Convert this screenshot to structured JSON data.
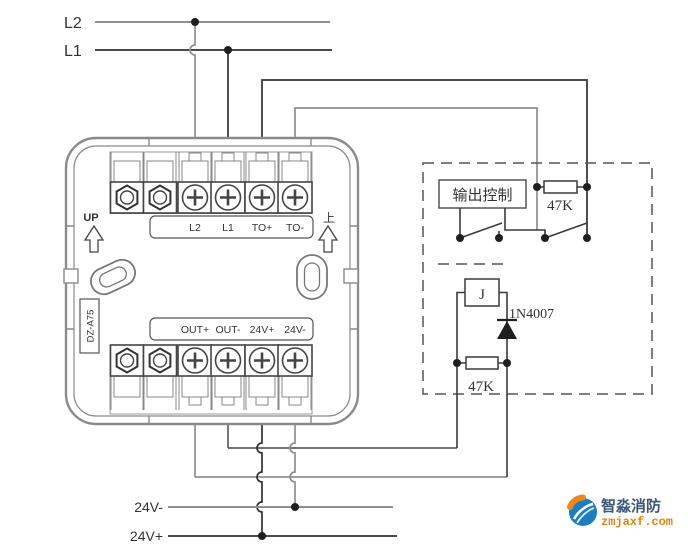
{
  "bus": {
    "l2": "L2",
    "l1": "L1",
    "v24_minus": "24V-",
    "v24_plus": "24V+"
  },
  "module": {
    "model": "DZ-A75",
    "orient_en": "UP",
    "orient_cn": "上",
    "top_terminals": [
      "L2",
      "L1",
      "TO+",
      "TO-"
    ],
    "bottom_terminals": [
      "OUT+",
      "OUT-",
      "24V+",
      "24V-"
    ]
  },
  "circuit": {
    "output_control": "输出控制",
    "line_resistor": "47K",
    "relay": "J",
    "diode": "1N4007",
    "coil_resistor": "47K"
  },
  "watermark": {
    "brand": "智淼消防",
    "site": "zmjaxf.com"
  },
  "colors": {
    "wire_dark": "#303030",
    "wire_gray": "#8f8f8f",
    "wire_mid": "#606060",
    "component": "#3a3a3a",
    "case_gray": "#8a8a8a",
    "dot": "#1f1f1f",
    "logo_blue": "#1b7ec2",
    "logo_orange": "#f08519",
    "brand_text": "#3c5877",
    "site_text": "#e8820c"
  }
}
